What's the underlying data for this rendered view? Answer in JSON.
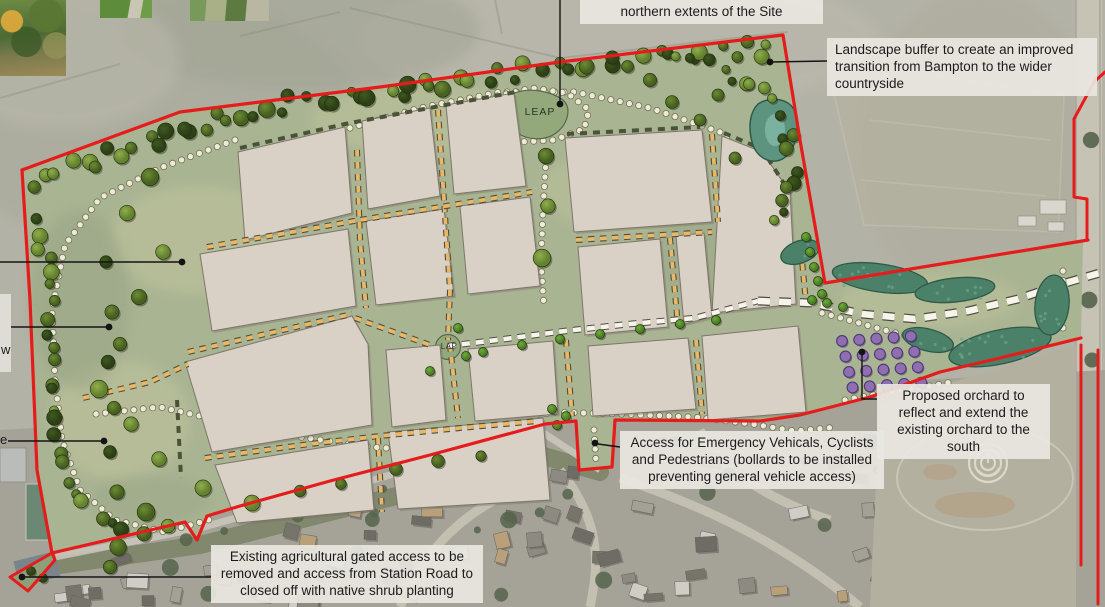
{
  "map_labels": {
    "leap": "LEAP",
    "lap": "LAP"
  },
  "callouts": {
    "northern": {
      "text": "northern extents of the Site"
    },
    "landscape_buffer": {
      "text": "Landscape buffer to create an improved transition from Bampton to the wider countryside"
    },
    "orchard": {
      "text": "Proposed orchard to reflect and extend the existing orchard to the south"
    },
    "emergency_access": {
      "text": "Access for Emergency Vehicals, Cyclists and Pedestrians (bollards to be installed preventing general vehicle access)"
    },
    "agricultural_access": {
      "text": "Existing agricultural gated access to be removed and access from Station Road to closed off with native shrub planting"
    },
    "left_fragment_w": {
      "text": "w"
    },
    "left_fragment_e": {
      "text": "e"
    }
  },
  "palette": {
    "boundary_red": "#e51c1b",
    "site_green": "#a9b493",
    "meadow_light": "#c2c49c",
    "meadow_dark": "#97a383",
    "parcel_fill": "#d9d0c6",
    "parcel_edge": "#7d766a",
    "street_orange": "#e9b765",
    "street_white": "#f7f4ec",
    "dash_outline": "#4e4e40",
    "hedge_dash": "#4a5238",
    "path_dot": "#efe9d8",
    "path_dot_edge": "#6f7355",
    "wetland": "#4c8169",
    "wetland_edge": "#2f5a46",
    "pond": "#5d9480",
    "pond_light": "#83b8a6",
    "orchard_purple": "#8f6fb0",
    "orchard_edge": "#4f3979",
    "play_area": "#93a97c",
    "play_area_edge": "#57684a",
    "leader": "#141414",
    "field_base": "#b3b2a6",
    "housing_base": "#a5a398",
    "road_light": "#c6c3b5"
  }
}
